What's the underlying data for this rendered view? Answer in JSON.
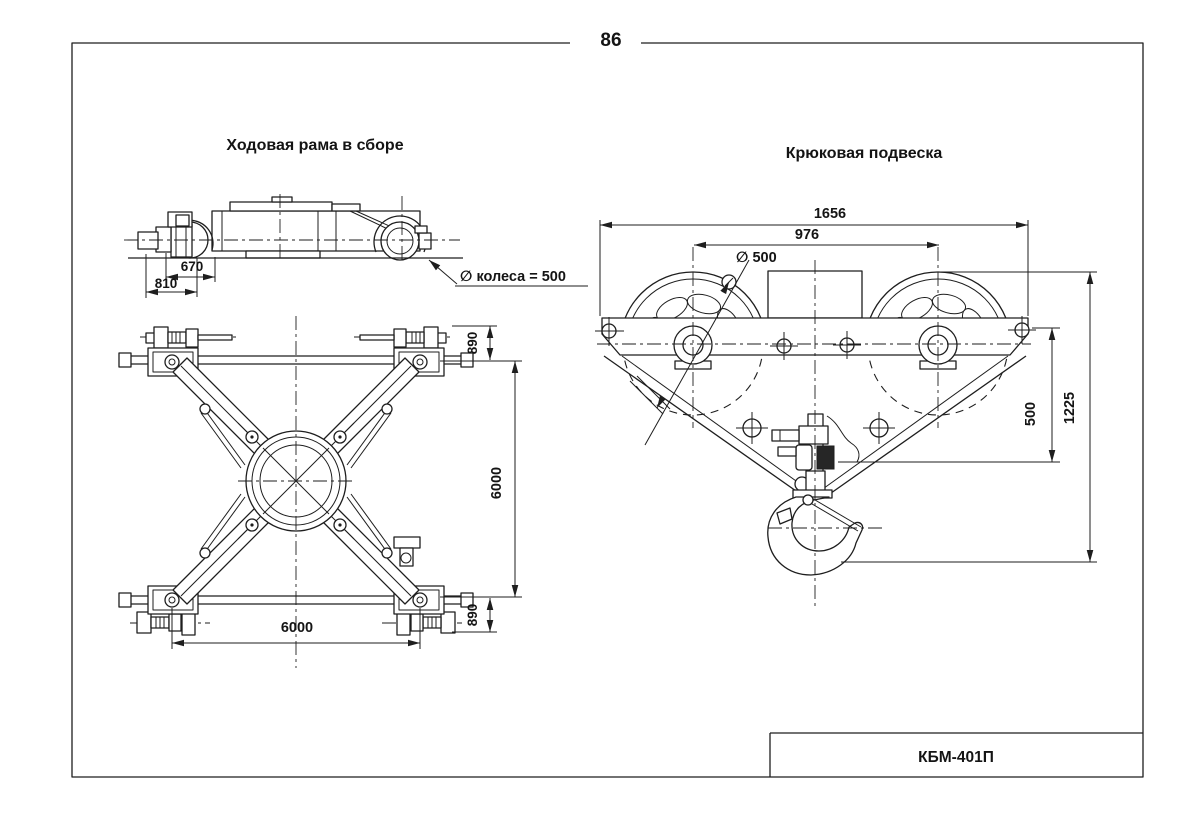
{
  "page": {
    "number": "86"
  },
  "left_drawing": {
    "title": "Ходовая рама в сборе",
    "wheel_note": "∅ колеса = 500",
    "dims": {
      "d670": "670",
      "d810": "810",
      "d890_top": "890",
      "d6000_v": "6000",
      "d890_bottom": "890",
      "d6000_h": "6000"
    }
  },
  "right_drawing": {
    "title": "Крюковая подвеска",
    "dims": {
      "d1656": "1656",
      "d976": "976",
      "d_dia500": "∅ 500",
      "d500": "500",
      "d1225": "1225"
    }
  },
  "title_block": {
    "model": "КБМ-401П"
  }
}
